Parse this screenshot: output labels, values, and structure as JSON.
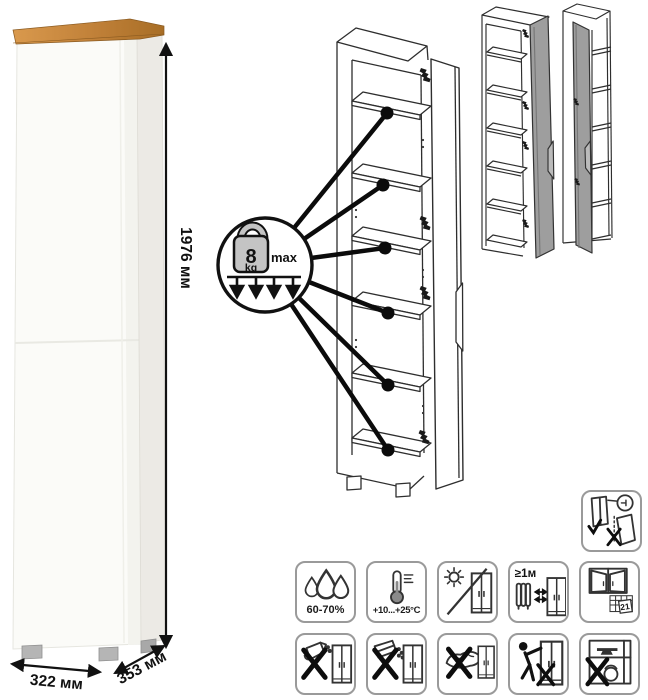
{
  "product": {
    "kind": "tall one-door cabinet with wood top",
    "dimensions": {
      "height": "1976 мм",
      "width": "322 мм",
      "depth": "353 мм"
    },
    "shelf_load": {
      "value": "8",
      "unit": "kg",
      "qualifier": "max"
    }
  },
  "diagrams": {
    "exploded_view": "open cabinet line drawing with six shelves, callout lines from load badge to each shelf",
    "variants": [
      "door-hinged-right-gray-front",
      "door-hinged-left-gray-front"
    ]
  },
  "care_icons": {
    "humidity": {
      "icon": "water-drops-icon",
      "label": "60-70%"
    },
    "temperature": {
      "icon": "thermometer-icon",
      "label": "+10...+25°C"
    },
    "sunlight": {
      "icon": "no-direct-sunlight-icon",
      "label": ""
    },
    "heat_distance": {
      "icon": "radiator-distance-icon",
      "label": "≥1м"
    },
    "ventilation": {
      "icon": "open-window-calendar-icon",
      "label": "21"
    },
    "no_liquids": {
      "icon": "no-pouring-liquids-icon"
    },
    "no_powder": {
      "icon": "no-scattering-powder-icon"
    },
    "no_wet_cloth": {
      "icon": "no-wet-cloth-icon"
    },
    "no_hanging": {
      "icon": "no-hanging-on-door-icon"
    },
    "no_heavy": {
      "icon": "no-heavy-objects-icon"
    }
  },
  "safety": {
    "wall_anchor": {
      "icon": "wall-anchoring-required-icon"
    }
  },
  "colors": {
    "wood_top_light": "#d9994d",
    "wood_top_dark": "#a86e26",
    "cabinet_front": "#fbfbf8",
    "cabinet_side": "#eceae5",
    "door_gray": "#9e9e9e",
    "line_art": "#2e2e2e",
    "annotation": "#111111",
    "icon_border": "#9a9a9a",
    "foot_gray": "#b5b5b5"
  }
}
